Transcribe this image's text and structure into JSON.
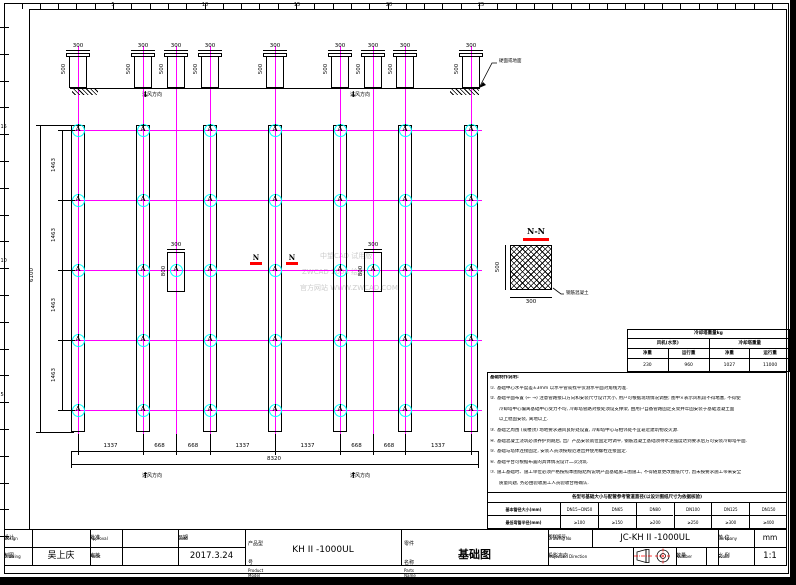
{
  "sheet": {
    "background": "#ffffff",
    "line_color": "#000000",
    "centerline_color": "#ff00ff",
    "anchor_ring_color": "#00ffff",
    "accent_red": "#ff0000",
    "watermark_color": "#cccccc"
  },
  "watermark": {
    "line1": "中望CAD 试用版",
    "line2": "ZWCAD 2008 绘制",
    "line3": "官方网站 WWW.ZWCAD.COM"
  },
  "elevation": {
    "pedestal_top_dim": "300",
    "pedestal_side_dim": "500",
    "ground_label": "硬面或地面"
  },
  "airflow": {
    "label": "进风方向",
    "down_arrow": "↓",
    "up_arrow": "↑"
  },
  "plan": {
    "anchor_label": "A",
    "row_dim_label": "1463",
    "row_overall_label": "6100",
    "col_dim_labels": [
      "1337",
      "668",
      "668",
      "1337",
      "1337",
      "668",
      "668",
      "1337"
    ],
    "col_overall_label": "8320",
    "detail_top_dim": "300",
    "detail_side_dim": "800",
    "section_mark": "N"
  },
  "section_detail": {
    "title": "N-N",
    "side_dim": "500",
    "bottom_dim": "300",
    "material_label": "钢筋混凝土"
  },
  "weight_table": {
    "title": "冷却塔重量kg",
    "groups": [
      "风机(水泵)",
      "冷却塔重量"
    ],
    "headers": [
      "净重",
      "运行重",
      "净重",
      "运行重"
    ],
    "values": [
      "230",
      "960",
      "1027",
      "11000"
    ]
  },
  "notes": {
    "lines": [
      {
        "t": "基础制作说明:",
        "b": true,
        "ind": false
      },
      {
        "t": "①. 基础中心水平度差±3mm 以水平管或找平仪测水平面对角线为准.",
        "b": false,
        "ind": false
      },
      {
        "t": "②. 基础平面布置 (← →) 注意管路接口方向和安装尺寸设计大小, 用户可根据现场情况调整; 图中×表示风机段不得堵塞, 不得使",
        "b": false,
        "ind": false
      },
      {
        "t": "冷却塔中心偏离基础中心受力不均, 冷却塔管路对接处须设支撑架, 由用户自备管路固定支架并牢固安装于基础混凝土面",
        "b": false,
        "ind": true
      },
      {
        "t": "以上稳固安装, 离地以上.",
        "b": false,
        "ind": true
      },
      {
        "t": "③. 基础之周围 (或楼顶) 场地要求通风良好处设置, 冷却塔中心与相邻处不宜靠近建筑物及火源.",
        "b": false,
        "ind": false
      },
      {
        "t": "④. 基础混凝土浇筑必须养护到期后, 出厂产品安装就位固定时调平, 钢筋混凝土基础须待水泥强度达到要求后方可安装冷却塔平面.",
        "b": false,
        "ind": false
      },
      {
        "t": "⑤. 基础与塔体连接固定, 安装人员须按规范进出并使用螺栓连接固定.",
        "b": false,
        "ind": false
      },
      {
        "t": "⑥. 基础平台可根据布置的具体情况设计二次浇筑.",
        "b": false,
        "ind": false
      },
      {
        "t": "⑦. 施工基础时、施工单位必须严格按照本图纸结构说明产品基础施工图施工, 不得随意更改图纸尺寸, 因未按要求施工带来安全",
        "b": false,
        "ind": false
      },
      {
        "t": "质量问题, 务必由验收施工人员验收合格确认.",
        "b": false,
        "ind": true
      }
    ]
  },
  "pipe_table": {
    "header": "各型号基础大小与配管参考管道直径(以设计图纸尺寸为依据核验)",
    "rows": [
      [
        "基本管径大小(mm)",
        "DN15~DN50",
        "DN65",
        "DN80",
        "DN100",
        "DN125",
        "DN150"
      ],
      [
        "最低弯管半径(mm)",
        "≥100",
        "≥150",
        "≥200",
        "≥250",
        "≥300",
        "≥400"
      ]
    ]
  },
  "rulers": {
    "top_labels": [
      "5",
      "10",
      "15",
      "20",
      "25"
    ],
    "left_labels": [
      "15",
      "10",
      "5"
    ]
  },
  "title_block": {
    "design": {
      "zh": "设计",
      "en": "Design"
    },
    "drawing": {
      "zh": "制图",
      "en": "Drawing"
    },
    "approval": {
      "zh": "批准",
      "en": "Approval"
    },
    "audit": {
      "zh": "审核",
      "en": "Audit"
    },
    "date": {
      "zh": "日期",
      "en": "Date"
    },
    "product_model": {
      "zh": "产品型号",
      "en": "Product Model"
    },
    "parts_name": {
      "zh": "零件名称",
      "en": "Parts Name"
    },
    "drawing_no": {
      "zh": "图样编号",
      "en": "Drawing No"
    },
    "company": {
      "zh": "单 位",
      "en": "Company"
    },
    "projection": {
      "zh": "投影方向",
      "en": "Projection Direction"
    },
    "number": {
      "zh": "数量",
      "en": "Number"
    },
    "scale": {
      "zh": "比 例",
      "en": "Scale"
    },
    "values": {
      "design_by": "",
      "drawing_by": "吴上庆",
      "approval_by": "",
      "audit_by": "",
      "date": "2017.3.24",
      "product_model": "KH II -1000UL",
      "parts_name": "基础图",
      "drawing_no": "JC-KH II -1000UL",
      "unit": "mm",
      "number": "",
      "scale": "1:1"
    }
  }
}
